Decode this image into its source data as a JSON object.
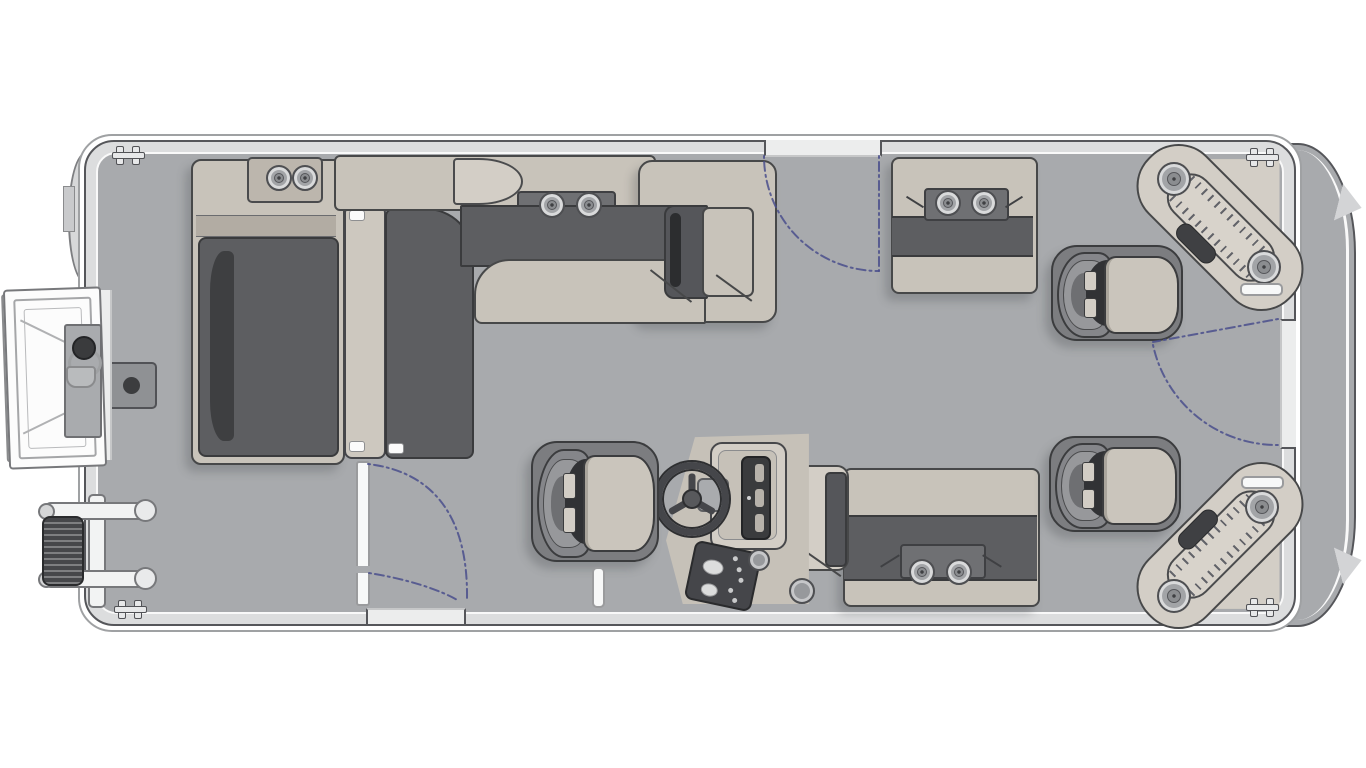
{
  "diagram": {
    "type": "pontoon-boat-floorplan",
    "subject": "Top-down deck layout of a pontoon boat, bow at left, stern at right",
    "text_content_present": false
  },
  "colors": {
    "background": "#ffffff",
    "outline": "#55565a",
    "hull_band": "#dcddde",
    "hull_white": "#f9f9f9",
    "deck_floor": "#a8aaad",
    "seat_light": "#c8c3ba",
    "seat_light2": "#d3cec6",
    "seat_mid": "#b2aca3",
    "seat_dark": "#5d5e61",
    "seat_darkest": "#3e3f41",
    "panel_gray": "#6f7073",
    "chair_shell": "#7c7d80",
    "cushion": "#cac5bc",
    "console_body": "#c6c1b8",
    "dark_trim": "#3a3b3d",
    "gate_dash": "#4a4f8c",
    "white_part": "#f5f6f6"
  },
  "components": {
    "speakers": [
      {
        "x": 277,
        "y": 176,
        "r": 11,
        "n": "bow-lounge-speaker-1"
      },
      {
        "x": 303,
        "y": 176,
        "r": 11,
        "n": "bow-lounge-speaker-2"
      },
      {
        "x": 550,
        "y": 203,
        "r": 11,
        "n": "forward-bench-speaker-1"
      },
      {
        "x": 587,
        "y": 203,
        "r": 11,
        "n": "forward-bench-speaker-2"
      },
      {
        "x": 946,
        "y": 201,
        "r": 11,
        "n": "aft-bench-top-speaker-1"
      },
      {
        "x": 982,
        "y": 201,
        "r": 11,
        "n": "aft-bench-top-speaker-2"
      },
      {
        "x": 920,
        "y": 570,
        "r": 11,
        "n": "aft-bench-bottom-speaker-1"
      },
      {
        "x": 957,
        "y": 570,
        "r": 11,
        "n": "aft-bench-bottom-speaker-2"
      },
      {
        "x": 1172,
        "y": 177,
        "r": 15,
        "n": "stern-corner-top-speaker-1"
      },
      {
        "x": 1262,
        "y": 265,
        "r": 15,
        "n": "stern-corner-top-speaker-2"
      },
      {
        "x": 1260,
        "y": 505,
        "r": 15,
        "n": "stern-corner-bottom-speaker-1"
      },
      {
        "x": 1172,
        "y": 594,
        "r": 15,
        "n": "stern-corner-bottom-speaker-2"
      }
    ],
    "cleats": [
      {
        "x": 112,
        "y": 146,
        "n": "cleat-bow-top"
      },
      {
        "x": 1246,
        "y": 148,
        "n": "cleat-stern-top"
      },
      {
        "x": 114,
        "y": 600,
        "n": "cleat-bow-bottom"
      },
      {
        "x": 1246,
        "y": 598,
        "n": "cleat-stern-bottom"
      }
    ],
    "chairs": [
      {
        "x": 531,
        "y": 441,
        "w": 124,
        "h": 117,
        "n": "helm-captain-chair"
      },
      {
        "x": 1051,
        "y": 245,
        "w": 128,
        "h": 92,
        "n": "aft-captain-chair-top"
      },
      {
        "x": 1049,
        "y": 436,
        "w": 128,
        "h": 92,
        "n": "aft-captain-chair-bottom"
      }
    ],
    "handles": [
      {
        "x": 1240,
        "y": 283,
        "w": 39,
        "h": 9,
        "n": "grab-handle-stern-top"
      },
      {
        "x": 1241,
        "y": 476,
        "w": 39,
        "h": 9,
        "n": "grab-handle-stern-bottom"
      },
      {
        "x": 592,
        "y": 567,
        "w": 9,
        "h": 37,
        "n": "deck-post"
      }
    ],
    "gates": [
      {
        "n": "forward-top-gate",
        "paths": [
          "M 764,156 A 115,115 0 0 0 879,271",
          "M 879,156 L 879,271"
        ]
      },
      {
        "n": "stern-side-gate",
        "paths": [
          "M 1278,319 L 1153,342",
          "M 1153,345 A 127,127 0 0 0 1278,445"
        ]
      },
      {
        "n": "midship-bottom-gate",
        "paths": [
          "M 368,464 C 436,472 468,520 467,598",
          "M 369,573 C 407,579 441,590 459,601"
        ]
      }
    ]
  },
  "inventory": [
    "bow boarding ladder",
    "port bow chaise lounges",
    "forward bench with corner seat",
    "aft bench top",
    "aft bench bottom",
    "helm console with steering wheel",
    "three captain chairs",
    "two diagonal stern corner loungers",
    "three swing gates",
    "deck table base plate"
  ]
}
